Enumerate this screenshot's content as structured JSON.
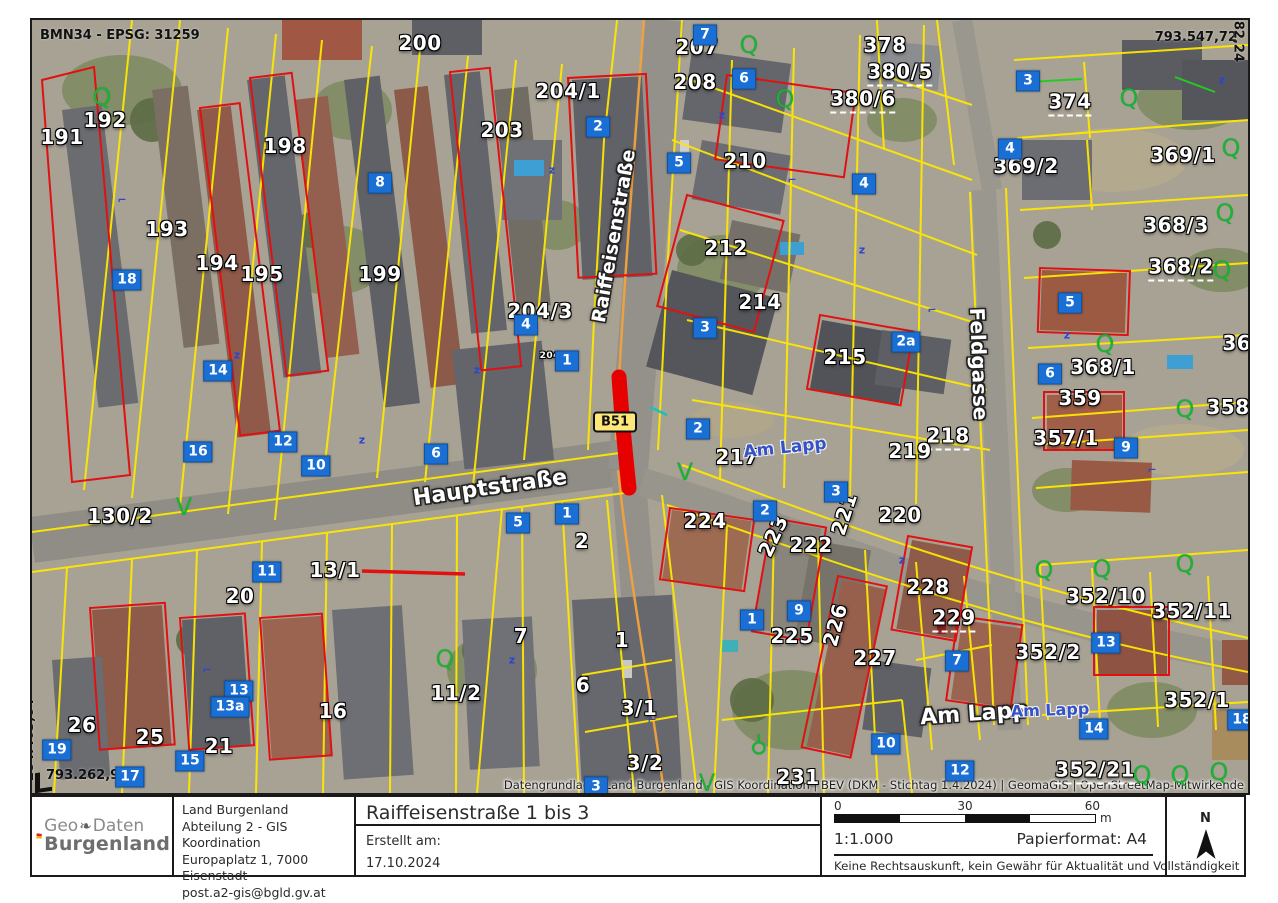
{
  "map": {
    "crs_label": "BMN34 - EPSG: 31259",
    "coord_top_right": "793.547,72",
    "coord_right_vertical": "284.582,24",
    "coord_left_vertical": "284.403,64",
    "coord_bottom_left": "793.262,94",
    "road_badge": "B51",
    "attribution": "Datengrundlage: Land Burgenland - GIS Koordination | BEV (DKM - Stichtag 1.4.2024) |  GeomaGIS | OpenStreetMap-Mitwirkende",
    "colors": {
      "parcel_line": "#ffe800",
      "building_outline": "#e11111",
      "highlight_segment": "#e60000",
      "house_number_bg": "#1a6fd4",
      "street_label_osm": "#3652c8",
      "vegetation_symbol": "#18b332",
      "road_badge_bg": "#ffe87a"
    },
    "street_labels": [
      {
        "t": "Raiffeisenstraße",
        "x": 582,
        "y": 216,
        "r": -80,
        "s": 19,
        "kind": "halo"
      },
      {
        "t": "Hauptstraße",
        "x": 458,
        "y": 468,
        "r": -8,
        "s": 22,
        "kind": "halo"
      },
      {
        "t": "Feldgasse",
        "x": 947,
        "y": 344,
        "r": 88,
        "s": 20,
        "kind": "halo"
      },
      {
        "t": "Am Lapp",
        "x": 942,
        "y": 694,
        "r": -4,
        "s": 22,
        "kind": "halo"
      },
      {
        "t": "Am Lapp",
        "x": 753,
        "y": 428,
        "r": -6,
        "s": 17,
        "kind": "osm"
      },
      {
        "t": "Am Lapp",
        "x": 1018,
        "y": 690,
        "r": -2,
        "s": 16,
        "kind": "osm"
      }
    ],
    "parcel_labels": [
      {
        "t": "191",
        "x": 30,
        "y": 117
      },
      {
        "t": "192",
        "x": 73,
        "y": 100
      },
      {
        "t": "193",
        "x": 135,
        "y": 209
      },
      {
        "t": "194",
        "x": 185,
        "y": 243
      },
      {
        "t": "195",
        "x": 230,
        "y": 254
      },
      {
        "t": "198",
        "x": 253,
        "y": 126
      },
      {
        "t": "199",
        "x": 348,
        "y": 254
      },
      {
        "t": "200",
        "x": 388,
        "y": 23
      },
      {
        "t": "203",
        "x": 470,
        "y": 110
      },
      {
        "t": "204/1",
        "x": 536,
        "y": 71
      },
      {
        "t": "204/3",
        "x": 508,
        "y": 291
      },
      {
        "t": "204/2",
        "x": 523,
        "y": 336,
        "s": 9
      },
      {
        "t": "207",
        "x": 665,
        "y": 27
      },
      {
        "t": "208",
        "x": 663,
        "y": 62
      },
      {
        "t": "210",
        "x": 713,
        "y": 141
      },
      {
        "t": "212",
        "x": 694,
        "y": 228
      },
      {
        "t": "214",
        "x": 728,
        "y": 282
      },
      {
        "t": "215",
        "x": 813,
        "y": 337
      },
      {
        "t": "217",
        "x": 705,
        "y": 437
      },
      {
        "t": "218",
        "x": 916,
        "y": 417,
        "c": "dash"
      },
      {
        "t": "219",
        "x": 878,
        "y": 431
      },
      {
        "t": "220",
        "x": 868,
        "y": 495
      },
      {
        "t": "221",
        "x": 812,
        "y": 494,
        "r": -72
      },
      {
        "t": "222",
        "x": 779,
        "y": 525
      },
      {
        "t": "223",
        "x": 741,
        "y": 516,
        "r": -65
      },
      {
        "t": "224",
        "x": 673,
        "y": 501
      },
      {
        "t": "225",
        "x": 760,
        "y": 616
      },
      {
        "t": "226",
        "x": 803,
        "y": 605,
        "r": -75
      },
      {
        "t": "227",
        "x": 843,
        "y": 638
      },
      {
        "t": "228",
        "x": 896,
        "y": 567
      },
      {
        "t": "229",
        "x": 922,
        "y": 599,
        "c": "dash"
      },
      {
        "t": "231",
        "x": 766,
        "y": 757
      },
      {
        "t": "374",
        "x": 1038,
        "y": 83,
        "c": "dash"
      },
      {
        "t": "369/2",
        "x": 994,
        "y": 146
      },
      {
        "t": "369/1",
        "x": 1151,
        "y": 135
      },
      {
        "t": "368/3",
        "x": 1144,
        "y": 205
      },
      {
        "t": "368/2",
        "x": 1149,
        "y": 248,
        "c": "dash"
      },
      {
        "t": "368/1",
        "x": 1071,
        "y": 347
      },
      {
        "t": "368",
        "x": 1212,
        "y": 323
      },
      {
        "t": "359",
        "x": 1048,
        "y": 378
      },
      {
        "t": "358",
        "x": 1196,
        "y": 387
      },
      {
        "t": "357/1",
        "x": 1034,
        "y": 418
      },
      {
        "t": "378",
        "x": 853,
        "y": 25
      },
      {
        "t": "380/5",
        "x": 868,
        "y": 53,
        "c": "dash"
      },
      {
        "t": "380/6",
        "x": 831,
        "y": 80,
        "c": "dash"
      },
      {
        "t": "130/2",
        "x": 88,
        "y": 496
      },
      {
        "t": "20",
        "x": 208,
        "y": 576
      },
      {
        "t": "13/1",
        "x": 303,
        "y": 550
      },
      {
        "t": "11/2",
        "x": 424,
        "y": 673
      },
      {
        "t": "16",
        "x": 301,
        "y": 691
      },
      {
        "t": "26",
        "x": 50,
        "y": 705
      },
      {
        "t": "25",
        "x": 118,
        "y": 717
      },
      {
        "t": "21",
        "x": 187,
        "y": 726
      },
      {
        "t": "1",
        "x": 590,
        "y": 620
      },
      {
        "t": "6",
        "x": 551,
        "y": 665
      },
      {
        "t": "7",
        "x": 489,
        "y": 616
      },
      {
        "t": "2",
        "x": 550,
        "y": 521
      },
      {
        "t": "3/1",
        "x": 607,
        "y": 688
      },
      {
        "t": "3/2",
        "x": 613,
        "y": 743
      },
      {
        "t": "352/10",
        "x": 1074,
        "y": 576
      },
      {
        "t": "352/11",
        "x": 1160,
        "y": 591
      },
      {
        "t": "352/2",
        "x": 1016,
        "y": 632
      },
      {
        "t": "352/1",
        "x": 1165,
        "y": 680
      },
      {
        "t": "352/21",
        "x": 1063,
        "y": 751,
        "c": "dash"
      }
    ],
    "house_numbers": [
      {
        "t": "2",
        "x": 566,
        "y": 107
      },
      {
        "t": "8",
        "x": 348,
        "y": 163
      },
      {
        "t": "18",
        "x": 95,
        "y": 260
      },
      {
        "t": "14",
        "x": 186,
        "y": 351
      },
      {
        "t": "16",
        "x": 166,
        "y": 432
      },
      {
        "t": "12",
        "x": 251,
        "y": 422
      },
      {
        "t": "10",
        "x": 284,
        "y": 446
      },
      {
        "t": "6",
        "x": 404,
        "y": 434
      },
      {
        "t": "4",
        "x": 494,
        "y": 305
      },
      {
        "t": "1",
        "x": 535,
        "y": 341
      },
      {
        "t": "11",
        "x": 235,
        "y": 552
      },
      {
        "t": "5",
        "x": 486,
        "y": 503
      },
      {
        "t": "1",
        "x": 535,
        "y": 494
      },
      {
        "t": "13",
        "x": 207,
        "y": 671
      },
      {
        "t": "13a",
        "x": 198,
        "y": 687
      },
      {
        "t": "15",
        "x": 158,
        "y": 741
      },
      {
        "t": "17",
        "x": 98,
        "y": 757
      },
      {
        "t": "19",
        "x": 25,
        "y": 730
      },
      {
        "t": "3",
        "x": 564,
        "y": 767
      },
      {
        "t": "7",
        "x": 673,
        "y": 15
      },
      {
        "t": "6",
        "x": 712,
        "y": 59
      },
      {
        "t": "5",
        "x": 647,
        "y": 143
      },
      {
        "t": "4",
        "x": 832,
        "y": 164
      },
      {
        "t": "3",
        "x": 673,
        "y": 308
      },
      {
        "t": "2",
        "x": 666,
        "y": 409
      },
      {
        "t": "2a",
        "x": 874,
        "y": 322
      },
      {
        "t": "2",
        "x": 733,
        "y": 491
      },
      {
        "t": "3",
        "x": 804,
        "y": 472
      },
      {
        "t": "1",
        "x": 720,
        "y": 600
      },
      {
        "t": "9",
        "x": 767,
        "y": 591
      },
      {
        "t": "7",
        "x": 925,
        "y": 641
      },
      {
        "t": "10",
        "x": 854,
        "y": 724
      },
      {
        "t": "12",
        "x": 928,
        "y": 751
      },
      {
        "t": "14",
        "x": 1062,
        "y": 709
      },
      {
        "t": "18",
        "x": 1210,
        "y": 700
      },
      {
        "t": "9",
        "x": 1094,
        "y": 428
      },
      {
        "t": "5",
        "x": 1038,
        "y": 283
      },
      {
        "t": "6",
        "x": 1018,
        "y": 354
      },
      {
        "t": "13",
        "x": 1074,
        "y": 623
      },
      {
        "t": "3",
        "x": 996,
        "y": 61
      },
      {
        "t": "4",
        "x": 978,
        "y": 129
      }
    ],
    "green_symbols": [
      {
        "t": "Q",
        "x": 70,
        "y": 77
      },
      {
        "t": "Q",
        "x": 1097,
        "y": 78
      },
      {
        "t": "Q",
        "x": 1199,
        "y": 128
      },
      {
        "t": "Q",
        "x": 1193,
        "y": 193
      },
      {
        "t": "Q",
        "x": 1190,
        "y": 250
      },
      {
        "t": "Q",
        "x": 1073,
        "y": 324
      },
      {
        "t": "Q",
        "x": 1153,
        "y": 389
      },
      {
        "t": "Q",
        "x": 413,
        "y": 639
      },
      {
        "t": "Q",
        "x": 717,
        "y": 25
      },
      {
        "t": "Q",
        "x": 753,
        "y": 79
      },
      {
        "t": "Q",
        "x": 1012,
        "y": 550
      },
      {
        "t": "Q",
        "x": 1070,
        "y": 549
      },
      {
        "t": "Q",
        "x": 1153,
        "y": 544
      },
      {
        "t": "Q",
        "x": 1110,
        "y": 755
      },
      {
        "t": "Q",
        "x": 1148,
        "y": 755
      },
      {
        "t": "Q",
        "x": 1187,
        "y": 752
      },
      {
        "t": "V",
        "x": 152,
        "y": 487
      },
      {
        "t": "V",
        "x": 675,
        "y": 763
      },
      {
        "t": "V",
        "x": 653,
        "y": 452
      },
      {
        "t": "⚲",
        "x": 727,
        "y": 725,
        "r": 180
      }
    ],
    "blue_marks": [
      {
        "t": "z",
        "x": 205,
        "y": 335
      },
      {
        "t": "z",
        "x": 445,
        "y": 350
      },
      {
        "t": "z",
        "x": 520,
        "y": 150
      },
      {
        "t": "z",
        "x": 690,
        "y": 95
      },
      {
        "t": "⌐",
        "x": 760,
        "y": 160
      },
      {
        "t": "z",
        "x": 830,
        "y": 230
      },
      {
        "t": "⌐",
        "x": 900,
        "y": 290
      },
      {
        "t": "z",
        "x": 480,
        "y": 640
      },
      {
        "t": "⌐",
        "x": 175,
        "y": 650
      },
      {
        "t": "z",
        "x": 1035,
        "y": 315
      },
      {
        "t": "⌐",
        "x": 1120,
        "y": 450
      },
      {
        "t": "z",
        "x": 870,
        "y": 540
      },
      {
        "t": "⌐",
        "x": 620,
        "y": 700
      },
      {
        "t": "z",
        "x": 330,
        "y": 420
      },
      {
        "t": "⌐",
        "x": 90,
        "y": 180
      },
      {
        "t": "z",
        "x": 1190,
        "y": 60
      }
    ]
  },
  "footer": {
    "logo": {
      "geo": "Geo",
      "leaf": "❧",
      "daten": "Daten",
      "burgenland": "Burgenland"
    },
    "org": {
      "line1": "Land Burgenland",
      "line2": "Abteilung 2 - GIS Koordination",
      "line3": "Europaplatz 1, 7000 Eisenstadt",
      "line4": "post.a2-gis@bgld.gv.at"
    },
    "title": "Raiffeisenstraße 1 bis 3",
    "created_label": "Erstellt am:",
    "created_date": "17.10.2024",
    "scalebar": {
      "t0": "0",
      "t30": "30",
      "t60": "60",
      "unit": "m"
    },
    "scale_text": "1:1.000",
    "paper_text": "Papierformat: A4",
    "disclaimer": "Keine Rechtsauskunft, kein Gewähr für Aktualität und Vollständigkeit",
    "north_label": "N"
  }
}
